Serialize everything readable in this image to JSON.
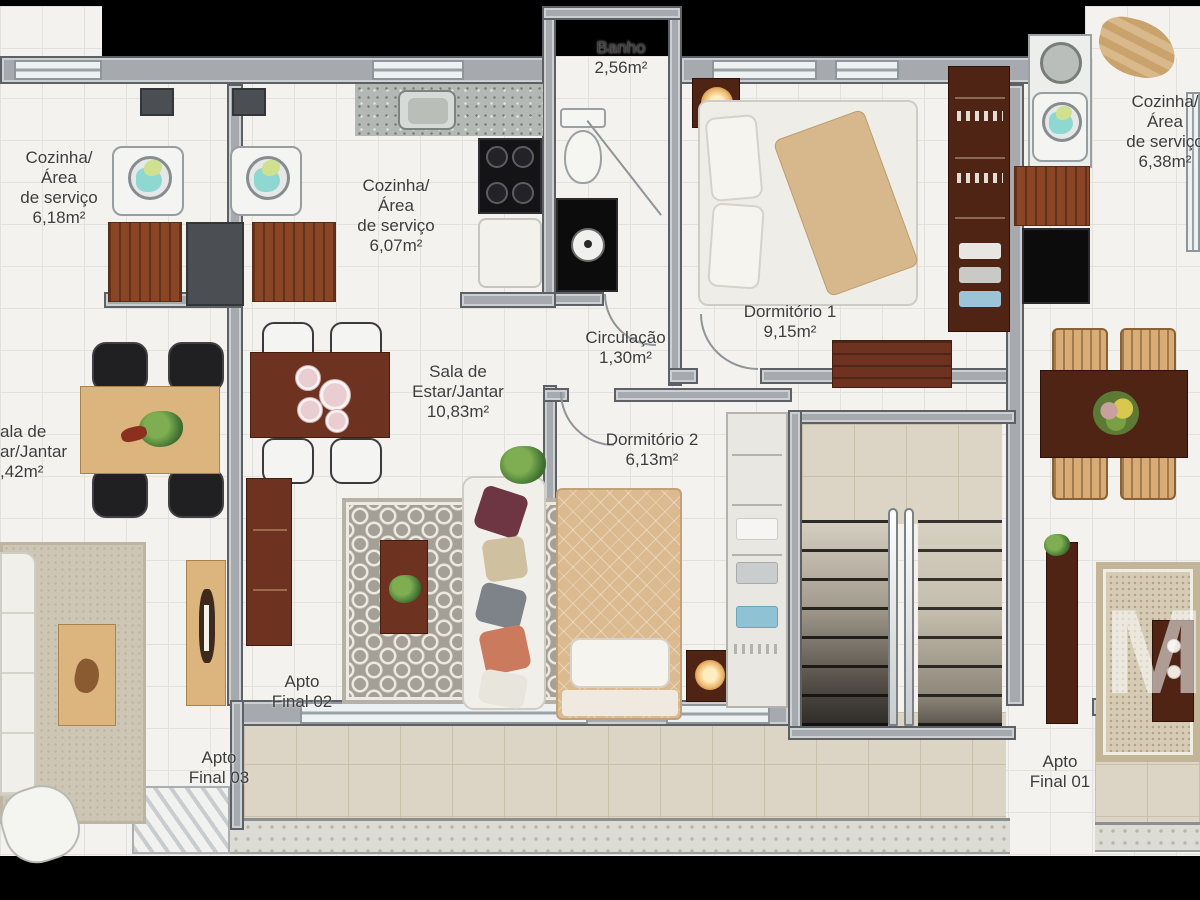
{
  "labels": {
    "kitchen_left": {
      "l1": "Cozinha/",
      "l2": "Área",
      "l3": "de serviço",
      "l4": "6,18m²"
    },
    "kitchen_mid": {
      "l1": "Cozinha/",
      "l2": "Área",
      "l3": "de serviço",
      "l4": "6,07m²"
    },
    "kitchen_right": {
      "l1": "Cozinha/",
      "l2": "Área",
      "l3": "de serviço",
      "l4": "6,38m²"
    },
    "bath": {
      "l1": "Banho",
      "l2": "2,56m²"
    },
    "dorm1": {
      "l1": "Dormitório 1",
      "l2": "9,15m²"
    },
    "dorm2": {
      "l1": "Dormitório 2",
      "l2": "6,13m²"
    },
    "circulacao": {
      "l1": "Circulação",
      "l2": "1,30m²"
    },
    "living_mid": {
      "l1": "Sala de",
      "l2": "Estar/Jantar",
      "l3": "10,83m²"
    },
    "living_left": {
      "l1": "ala de",
      "l2": "ar/Jantar",
      "l3": ",42m²"
    },
    "apto01": {
      "l1": "Apto",
      "l2": "Final 01"
    },
    "apto02": {
      "l1": "Apto",
      "l2": "Final 02"
    },
    "apto03": {
      "l1": "Apto",
      "l2": "Final 03"
    }
  },
  "watermark": {
    "text": "M"
  },
  "colors": {
    "background": "#000000",
    "wall_fill": "#a6aaae",
    "wall_edge": "#5d6165",
    "floor_tile": "#f3f2ee",
    "terrace_tile": "#dcd5c5",
    "wood_dark": "#6e3320",
    "wood_light": "#dcb47e",
    "mahogany": "#4f2414",
    "blanket_tan": "#d7b88c",
    "rug_gray": "#a5a097",
    "rug_beige": "#d6ccb6",
    "clothes_teal": "#8fd8d2",
    "label_text": "#3c3c3c"
  }
}
